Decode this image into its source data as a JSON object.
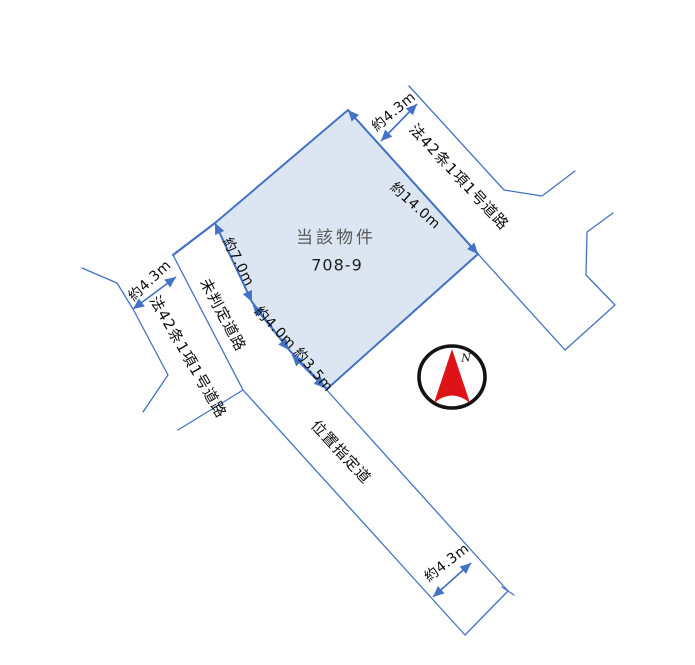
{
  "property": {
    "name": "当該物件",
    "lot_number": "708-9"
  },
  "dimensions": {
    "ne_edge": "約14.0m",
    "west_edge": "約7.0m",
    "sw_upper_edge": "約4.0m",
    "sw_lower_edge": "約3.5m",
    "road_width_top": "約4.3m",
    "road_width_left": "約4.3m",
    "road_width_bottom": "約4.3m"
  },
  "roads": {
    "top_right": "法42条1項1号道路",
    "left": "法42条1項1号道路",
    "undetermined": "未判定道路",
    "designated": "位置指定道"
  },
  "compass": {
    "label": "N"
  },
  "colors": {
    "line_blue": "#4472c4",
    "property_fill": "#dbe6f2",
    "property_name_gray": "#595959",
    "compass_red": "#df1217"
  }
}
